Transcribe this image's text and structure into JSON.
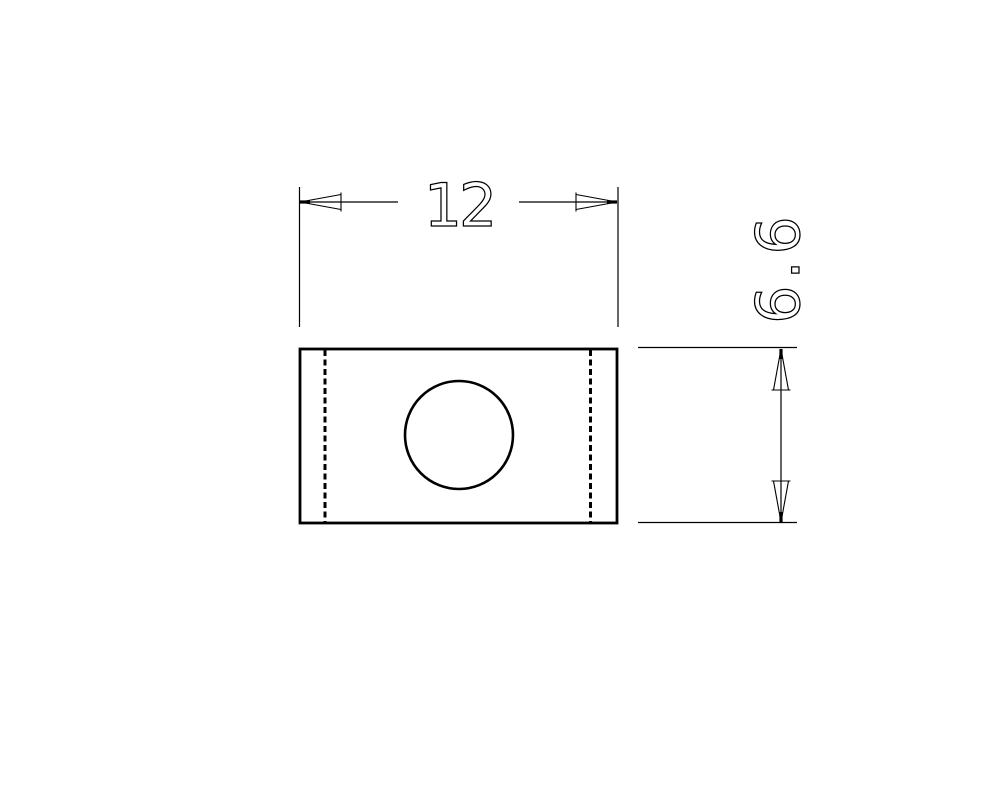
{
  "drawing": {
    "background_color": "#ffffff",
    "line_color": "#000000",
    "dimensions": {
      "horizontal": {
        "value": "12"
      },
      "vertical": {
        "value": "6.6"
      }
    }
  }
}
